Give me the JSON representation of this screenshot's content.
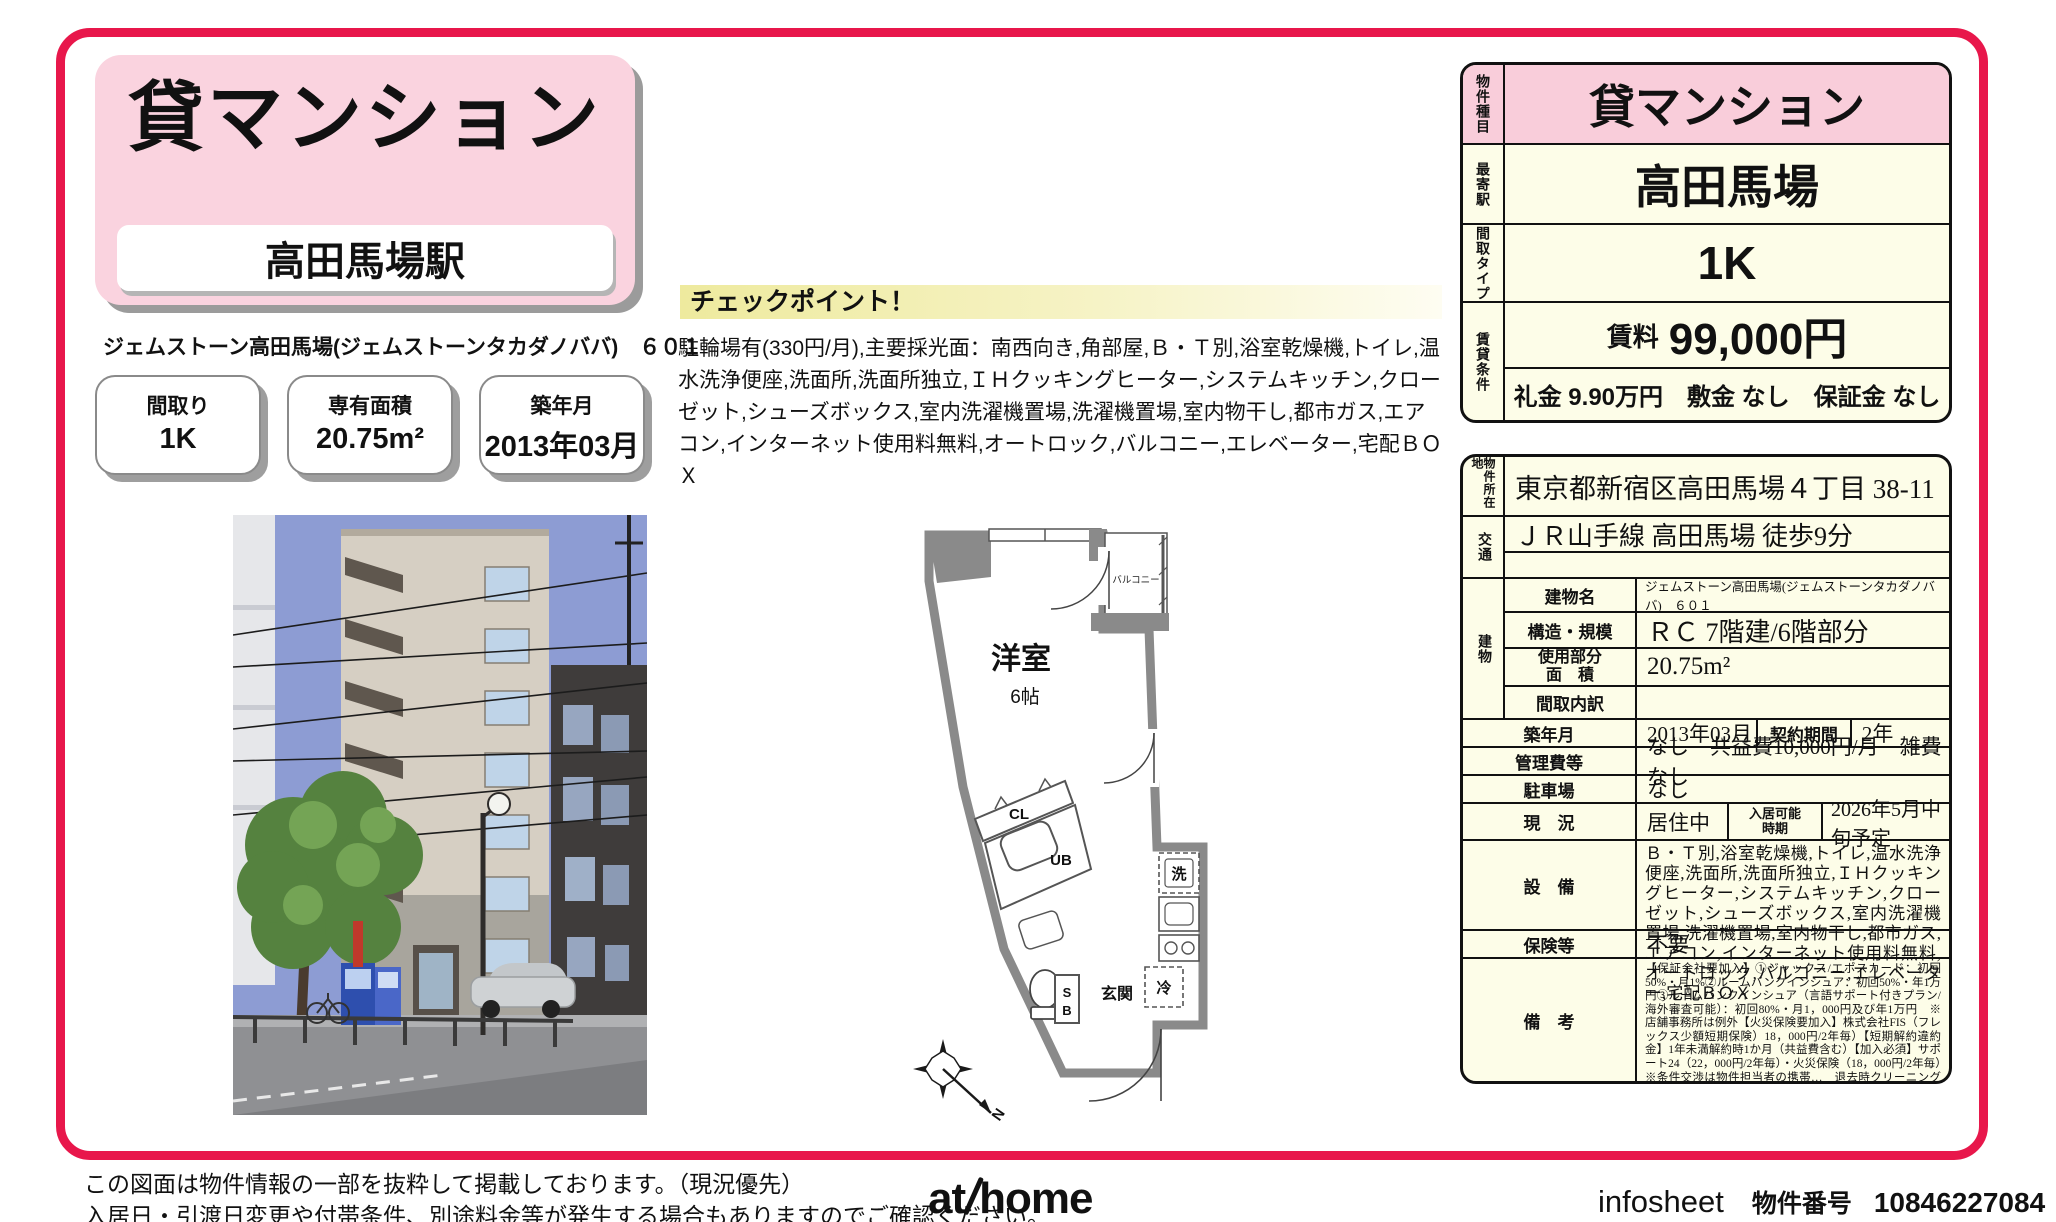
{
  "colors": {
    "accent_red": "#e8174b",
    "pink": "#f9cdda",
    "title_pink": "#fad3df",
    "cream": "#fdfde8"
  },
  "header": {
    "category": "貸マンション",
    "station": "高田馬場駅",
    "building_line": "ジェムストーン高田馬場(ジェムストーンタカダノババ)　６０１",
    "spec_boxes": [
      {
        "label": "間取り",
        "value": "1K"
      },
      {
        "label": "専有面積",
        "value": "20.75m²"
      },
      {
        "label": "築年月",
        "value": "2013年03月"
      }
    ]
  },
  "checkpoint": {
    "title": "チェックポイント！",
    "body": "駐輪場有(330円/月),主要採光面：南西向き,角部屋,Ｂ・Ｔ別,浴室乾燥機,トイレ,温水洗浄便座,洗面所,洗面所独立,ＩＨクッキングヒーター,システムキッチン,クローゼット,シューズボックス,室内洗濯機置場,洗濯機置場,室内物干し,都市ガス,エアコン,インターネット使用料無料,オートロック,バルコニー,エレベーター,宅配ＢＯＸ"
  },
  "summary": {
    "type_label": "物件種目",
    "type": "貸マンション",
    "station_label": "最寄駅",
    "station": "高田馬場",
    "layout_label": "間取タイプ",
    "layout": "1K",
    "terms_label": "賃貸条件",
    "rent_label": "賃料",
    "rent": "99,000円",
    "deposit_line": "礼金 9.90万円　敷金 なし　保証金 なし"
  },
  "detail": {
    "address_label": "物件所在地",
    "address": "東京都新宿区高田馬場４丁目 38-11",
    "access_label": "交通",
    "access1": "ＪＲ山手線 高田馬場 徒歩9分",
    "access2": "",
    "building_label": "建物",
    "bname_label": "建物名",
    "bname": "ジェムストーン高田馬場(ジェムストーンタカダノババ)　６０１",
    "structure_label": "構造・規模",
    "structure": "ＲＣ 7階建/6階部分",
    "area_label1": "使用部分",
    "area_label2": "面　積",
    "area": "20.75m²",
    "madori_label": "間取内訳",
    "madori": "",
    "built_label": "築年月",
    "built": "2013年03月",
    "term_label": "契約期間",
    "term": "2年",
    "fees_label": "管理費等",
    "fees": "なし　共益費10,000円/月　雑費なし",
    "parking_label": "駐車場",
    "parking": "なし",
    "status_label": "現　況",
    "status": "居住中",
    "movein_label1": "入居可能",
    "movein_label2": "時期",
    "movein": "2026年5月中旬予定",
    "equipment_label": "設　備",
    "equipment": "Ｂ・Ｔ別,浴室乾燥機,トイレ,温水洗浄便座,洗面所,洗面所独立,ＩＨクッキングヒーター,システムキッチン,クローゼット,シューズボックス,室内洗濯機置場,洗濯機置場,室内物干し,都市ガス,エアコン,インターネット使用料無料,オートロック,バルコニー,エレベーター,宅配ＢＯＸ",
    "insurance_label": "保険等",
    "insurance": "不要",
    "notes_label": "備　考",
    "notes": "【保証会社要加入】①ジャックス/エポスカード：初回50%・月1%②ルームバンクインシュア：初回50%・年1万円③ルームバンクインシュア（言語サポート付きプラン/海外審査可能）：初回80%・月1，000円及び年1万円　※店舗事務所は例外【火災保険要加入】株式会社FIS（フレックス少額短期保険）18，000円/2年毎）【短期解約違約金】1年未満解約時1か月（共益費含む）【加入必須】サポート24（22，000円/2年毎）・火災保険（18，000円/2年毎）　※条件交渉は物件担当者の携帯…　退去時クリーニング費用（契約時支払）：44,000円　サポート24：22,000円　町会費：100円/月　更新料：9.90万円　鍵交換代等：有　16,500円～　利用駅１：東京メトロ東西線 高田馬場 徒歩9分　利用駅２：ＪＲ総武・中央緩行線 東中野 徒歩15分"
  },
  "floorplan": {
    "room": "洋室",
    "size": "6帖",
    "balcony": "バルコニー",
    "cl": "CL",
    "ub": "UB",
    "wash": "洗",
    "fridge": "冷",
    "entrance": "玄関",
    "sb_s": "S",
    "sb_b": "B",
    "north": "N"
  },
  "footer": {
    "disclaimer1": "この図面は物件情報の一部を抜粋して掲載しております。（現況優先）",
    "disclaimer2": "入居日・引渡日変更や付帯条件、別途料金等が発生する場合もありますのでご確認ください。",
    "logo_at": "at",
    "logo_home": "home",
    "infosheet": "infosheet",
    "property_no_label": "物件番号",
    "property_no": "10846227084"
  }
}
